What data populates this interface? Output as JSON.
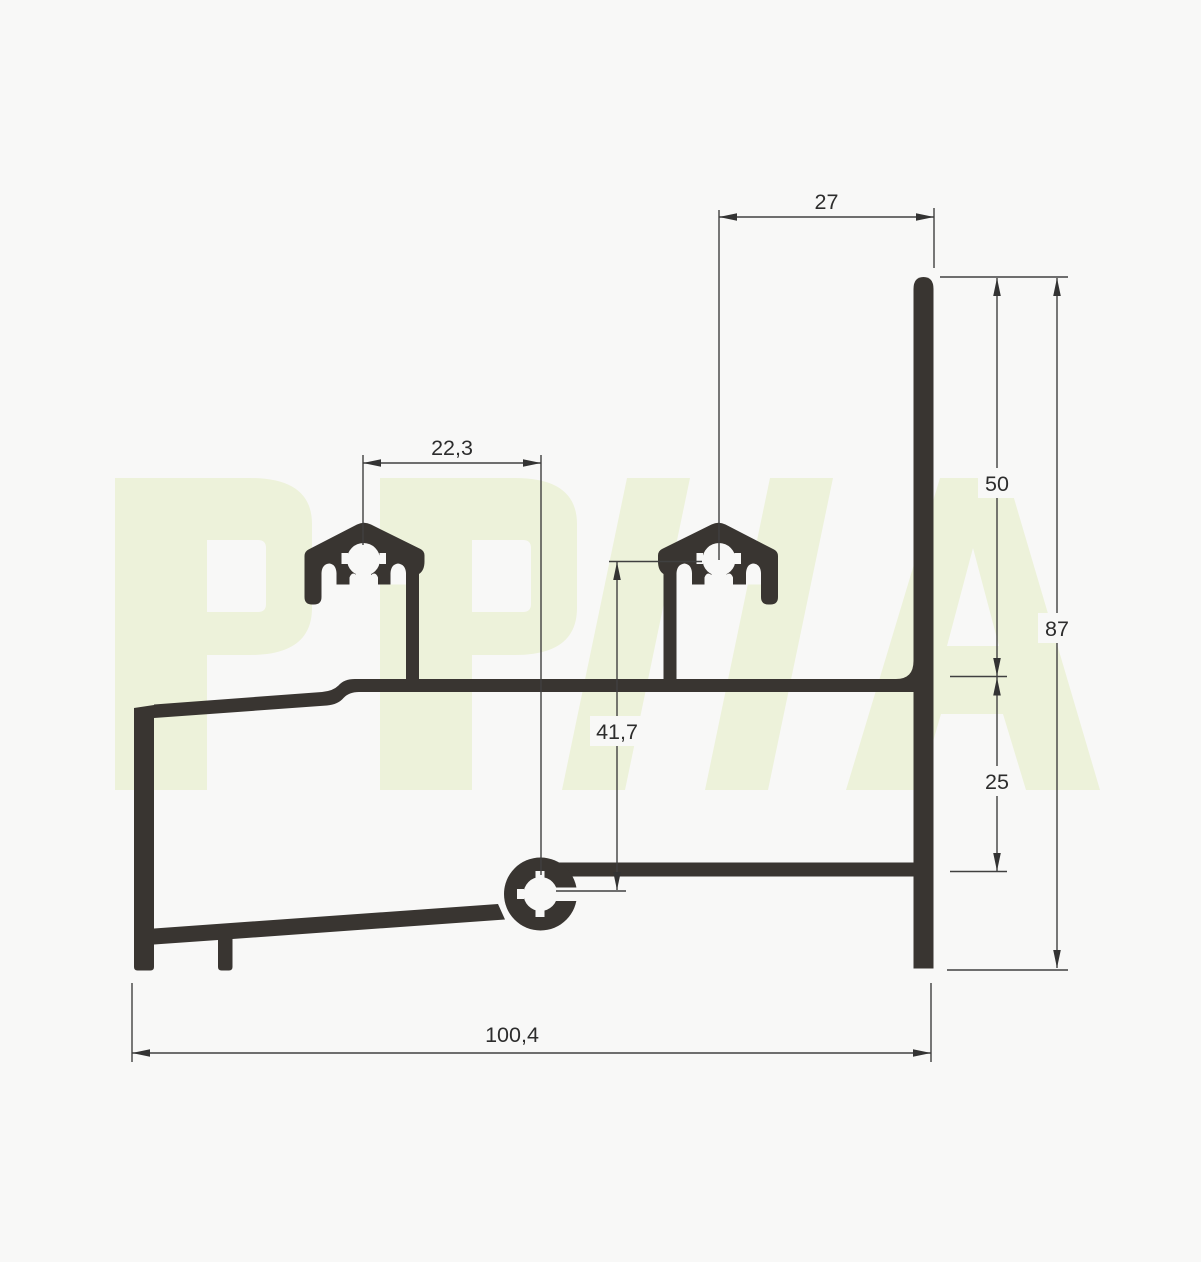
{
  "watermark": {
    "text": "PP//A",
    "color": "#edf2da"
  },
  "drawing": {
    "type": "aluminium-profile-cross-section",
    "colors": {
      "background": "#f8f8f7",
      "profile": "#393531",
      "dimension_lines": "#404040",
      "text": "#2d2d2d"
    },
    "dimensions": {
      "wall_offset_top": "27",
      "clip_to_port_spacing": "22,3",
      "upper_wall_height": "50",
      "total_height": "87",
      "clip_to_port_height": "41,7",
      "lower_wall_height": "25",
      "total_width": "100,4"
    }
  }
}
